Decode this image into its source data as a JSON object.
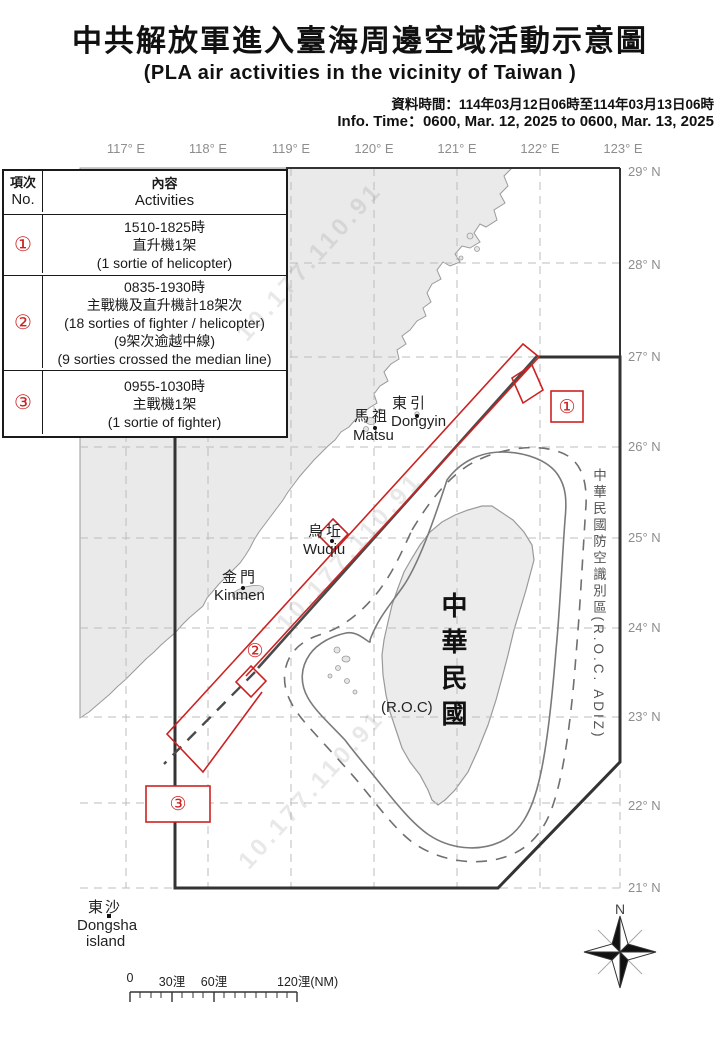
{
  "header": {
    "title_zh": "中共解放軍進入臺海周邊空域活動示意圖",
    "title_en": "(PLA air activities in the vicinity of Taiwan )",
    "data_time_zh": "資料時間：114年03月12日06時至114年03月13日06時",
    "info_time_en": "Info. Time：0600, Mar. 12, 2025 to 0600, Mar. 13, 2025"
  },
  "table": {
    "header": {
      "no_zh": "項次",
      "no_en": "No.",
      "act_zh": "內容",
      "act_en": "Activities"
    },
    "rows": [
      {
        "num": "①",
        "lines": [
          "1510-1825時",
          "直升機1架",
          "(1 sortie of helicopter)"
        ]
      },
      {
        "num": "②",
        "lines": [
          "0835-1930時",
          "主戰機及直升機計18架次",
          "(18 sorties of fighter / helicopter)",
          "(9架次逾越中線)",
          "(9 sorties crossed the median line)"
        ]
      },
      {
        "num": "③",
        "lines": [
          "0955-1030時",
          "主戰機1架",
          "(1 sortie of fighter)"
        ]
      }
    ]
  },
  "map": {
    "lon_labels": [
      "117° E",
      "118° E",
      "119° E",
      "120° E",
      "121° E",
      "122° E",
      "123° E"
    ],
    "lat_labels": [
      "29° N",
      "28° N",
      "27° N",
      "26° N",
      "25° N",
      "24° N",
      "23° N",
      "22° N",
      "21° N"
    ],
    "adiz_label": "中華民國防空識別區(R.O.C. ADIZ)",
    "taiwan_vertical": "中華民國",
    "roc": "(R.O.C)",
    "places": {
      "dongyin": {
        "zh": "東引",
        "en": "Dongyin"
      },
      "matsu": {
        "zh": "馬祖",
        "en": "Matsu"
      },
      "wuqiu": {
        "zh": "烏坵",
        "en": "Wuqiu"
      },
      "kinmen": {
        "zh": "金門",
        "en": "Kinmen"
      },
      "dongsha": {
        "zh": "東沙",
        "en_1": "Dongsha",
        "en_2": "island"
      }
    },
    "markers": {
      "m1": "①",
      "m2": "②",
      "m3": "③"
    },
    "watermark": "10.177.110.91",
    "compass_n": "N",
    "scale": {
      "t0": "0",
      "t30": "30浬",
      "t60": "60浬",
      "t120": "120浬(NM)"
    }
  },
  "colors": {
    "marker_red": "#cc2222",
    "boundary_dark": "#3a3a3a",
    "grid_gray": "#bcbcbc",
    "land_fill": "#eaeaea",
    "coast_gray": "#9a9a9a",
    "label_gray": "#8e8e8e"
  }
}
